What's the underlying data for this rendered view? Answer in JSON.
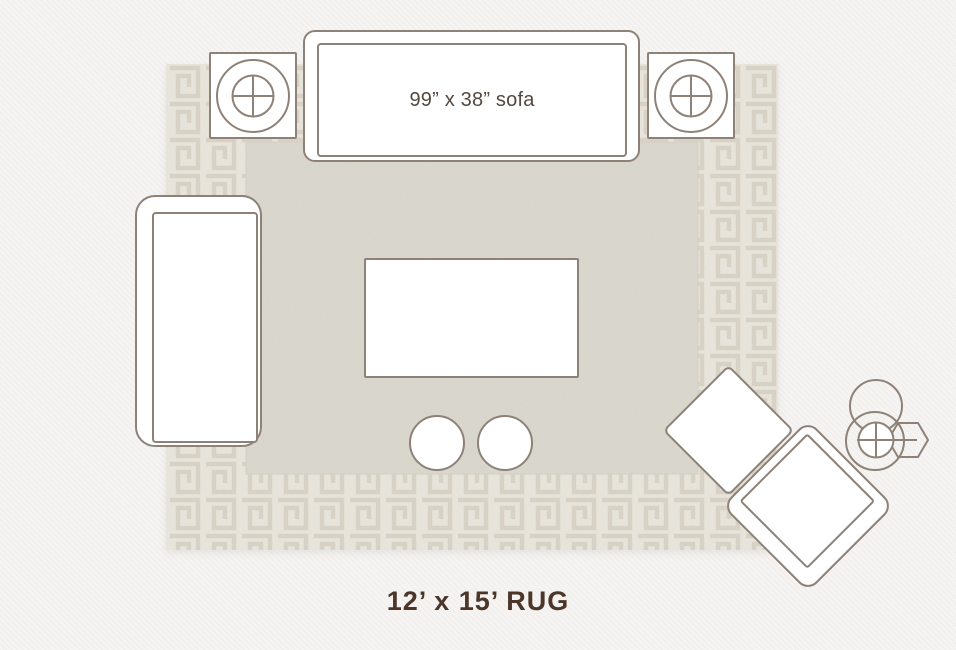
{
  "colors": {
    "background": "#f5f4f2",
    "outline": "#8e8278",
    "furniture_fill": "#ffffff",
    "rug_border_bg": "#ebe8df",
    "rug_fret": "#d6d1c2",
    "rug_field": "#dcd9d0",
    "sofa_label_color": "#54493f",
    "rug_label_color": "#4b3629"
  },
  "sofa": {
    "label": "99” x 38” sofa"
  },
  "rug": {
    "label": "12’ x 15’ RUG"
  }
}
